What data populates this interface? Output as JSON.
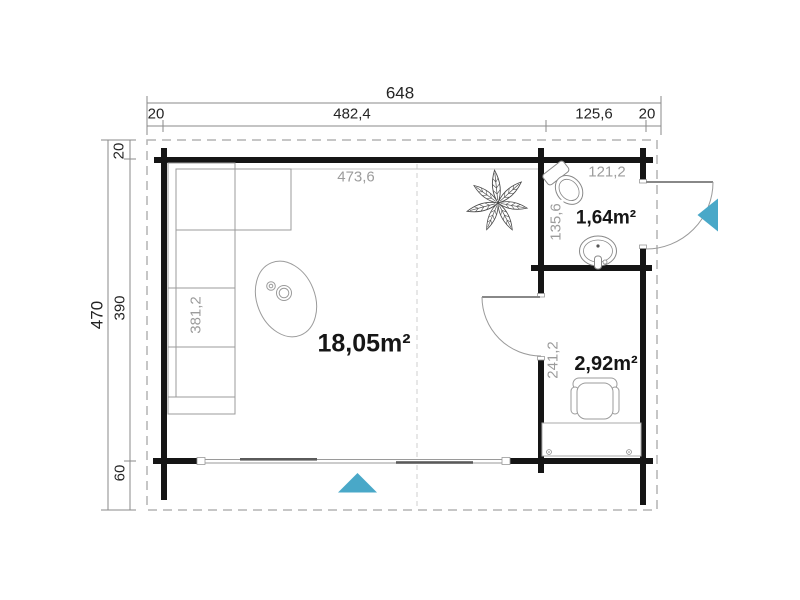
{
  "plan_title": "cabin-floor-plan",
  "dimensions": {
    "top": {
      "total": "648",
      "segments": [
        "20",
        "482,4",
        "125,6",
        "20"
      ]
    },
    "left": {
      "total": "470",
      "segments": [
        "20",
        "390",
        "60"
      ]
    }
  },
  "interior": {
    "living_width": "473,6",
    "sofa_length": "381,2",
    "wc_width": "121,2",
    "wc_depth": "135,6",
    "office_depth": "241,2"
  },
  "rooms": {
    "living": {
      "area": "18,05m²"
    },
    "wc": {
      "area": "1,64m²"
    },
    "office": {
      "area": "2,92m²"
    }
  },
  "colors": {
    "arrow": "#49a8c8",
    "wall": "#151515",
    "furniture_outline": "#999999",
    "dim_gray": "#9c9c9c"
  }
}
